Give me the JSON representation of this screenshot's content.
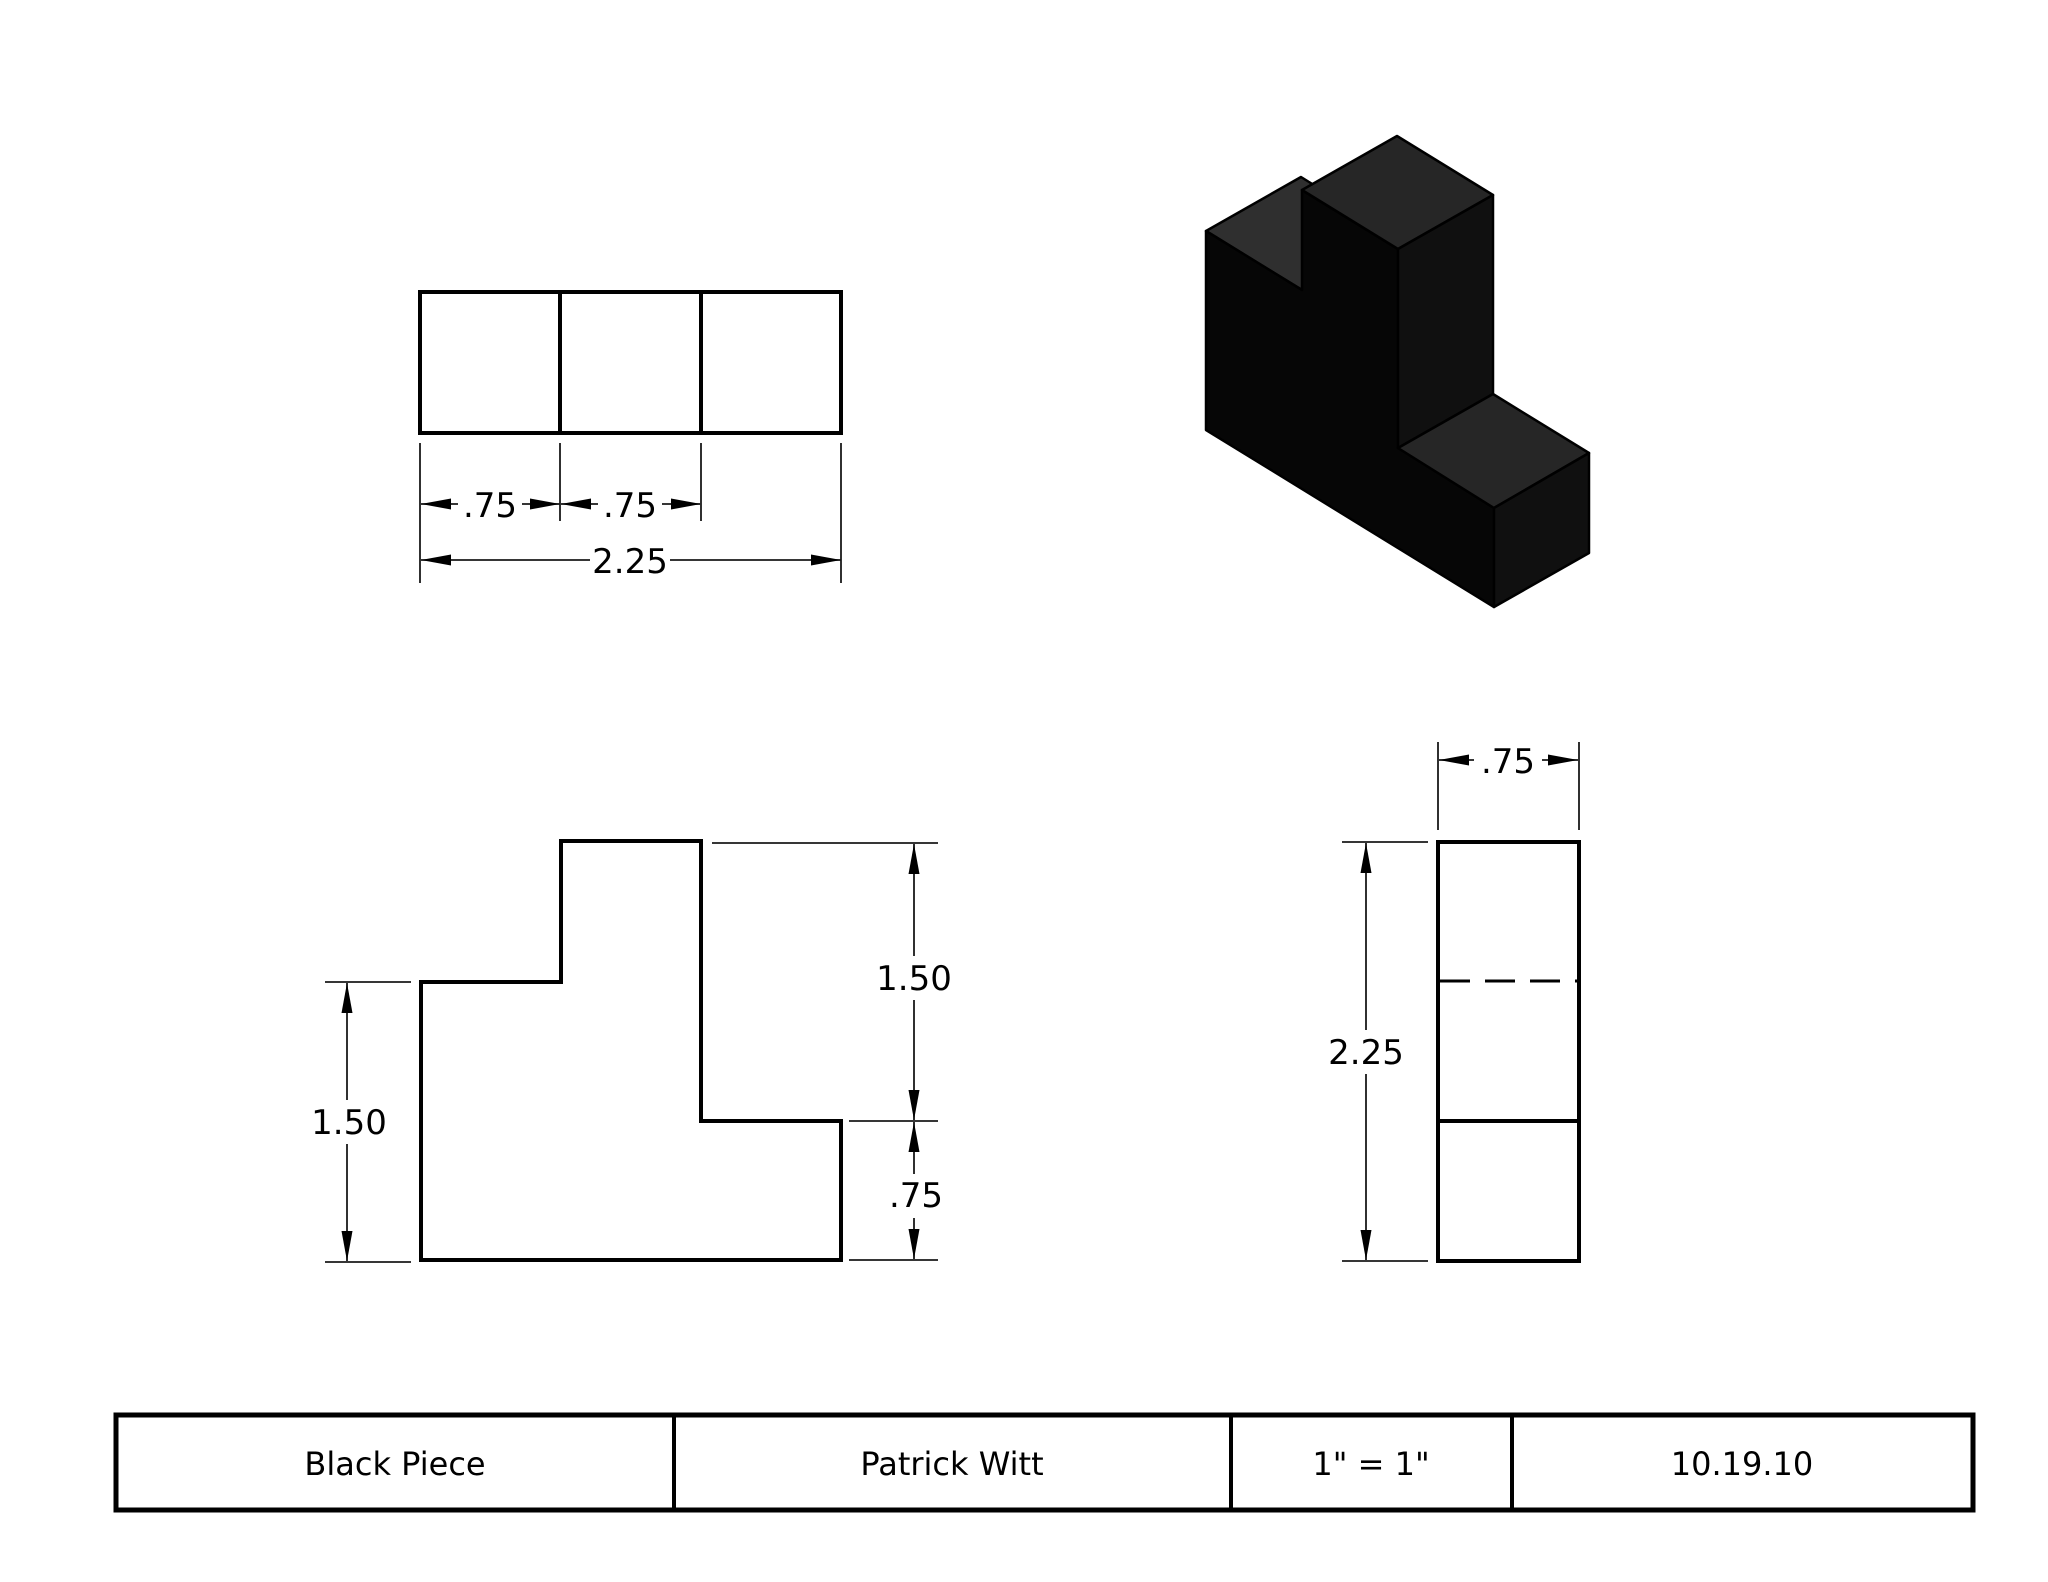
{
  "drawing": {
    "top_view": {
      "dim_left": ".75",
      "dim_mid": ".75",
      "dim_total": "2.25"
    },
    "front_view": {
      "dim_left_height": "1.50",
      "dim_right_upper": "1.50",
      "dim_right_lower": ".75"
    },
    "side_view": {
      "dim_width": ".75",
      "dim_height": "2.25"
    },
    "isometric": {
      "front_color": "#060606",
      "top_color": "#262626",
      "notch_color": "#2f2f2f",
      "side_color": "#101010",
      "edge_color": "#000000"
    },
    "title_block": {
      "part_name": "Black Piece",
      "author": "Patrick Witt",
      "scale": "1\" = 1\"",
      "date": "10.19.10"
    }
  }
}
